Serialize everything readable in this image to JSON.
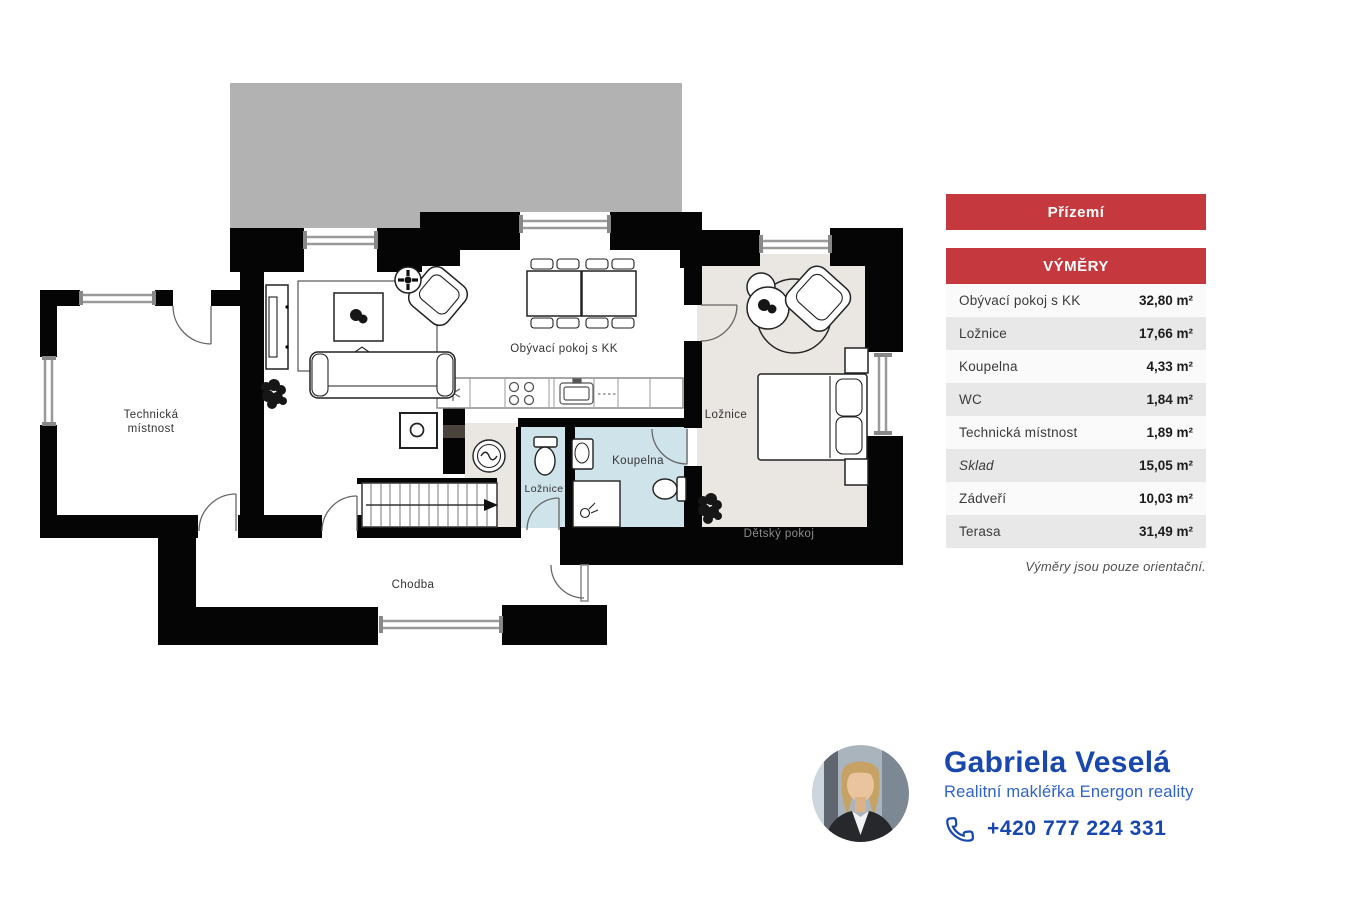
{
  "plan": {
    "labels": {
      "living": "Obývací pokoj s KK",
      "bedroom": "Ložnice",
      "bathroom": "Koupelna",
      "small_room": "Ložnice",
      "technical_1": "Technická",
      "technical_2": "místnost",
      "hallway": "Chodba",
      "kids_room": "Dětský pokoj"
    },
    "colors": {
      "terrace": "#b2b2b2",
      "bedroom_floor": "#eae6e1",
      "bathroom_floor": "#cfe4ea",
      "entry_floor": "#eae6e1",
      "wall": "#050505",
      "kids_room_text": "#8c8c8c"
    }
  },
  "panel": {
    "floor_title": "Přízemí",
    "table_title": "VÝMĚRY",
    "header_bg": "#c5383d",
    "rows": [
      {
        "label": "Obývací pokoj s KK",
        "value": "32,80 m²"
      },
      {
        "label": "Ložnice",
        "value": "17,66 m²"
      },
      {
        "label": "Koupelna",
        "value": "4,33 m²"
      },
      {
        "label": "WC",
        "value": "1,84 m²"
      },
      {
        "label": "Technická místnost",
        "value": "1,89 m²"
      },
      {
        "label": "Sklad",
        "value": "15,05 m²"
      },
      {
        "label": "Zádveří",
        "value": "10,03 m²"
      },
      {
        "label": "Terasa",
        "value": "31,49 m²"
      }
    ],
    "note": "Výměry jsou pouze orientační."
  },
  "agent": {
    "name": "Gabriela Veselá",
    "role": "Realitní makléřka Energon reality",
    "phone": "+420 777 224 331",
    "accent": "#1847ae"
  }
}
